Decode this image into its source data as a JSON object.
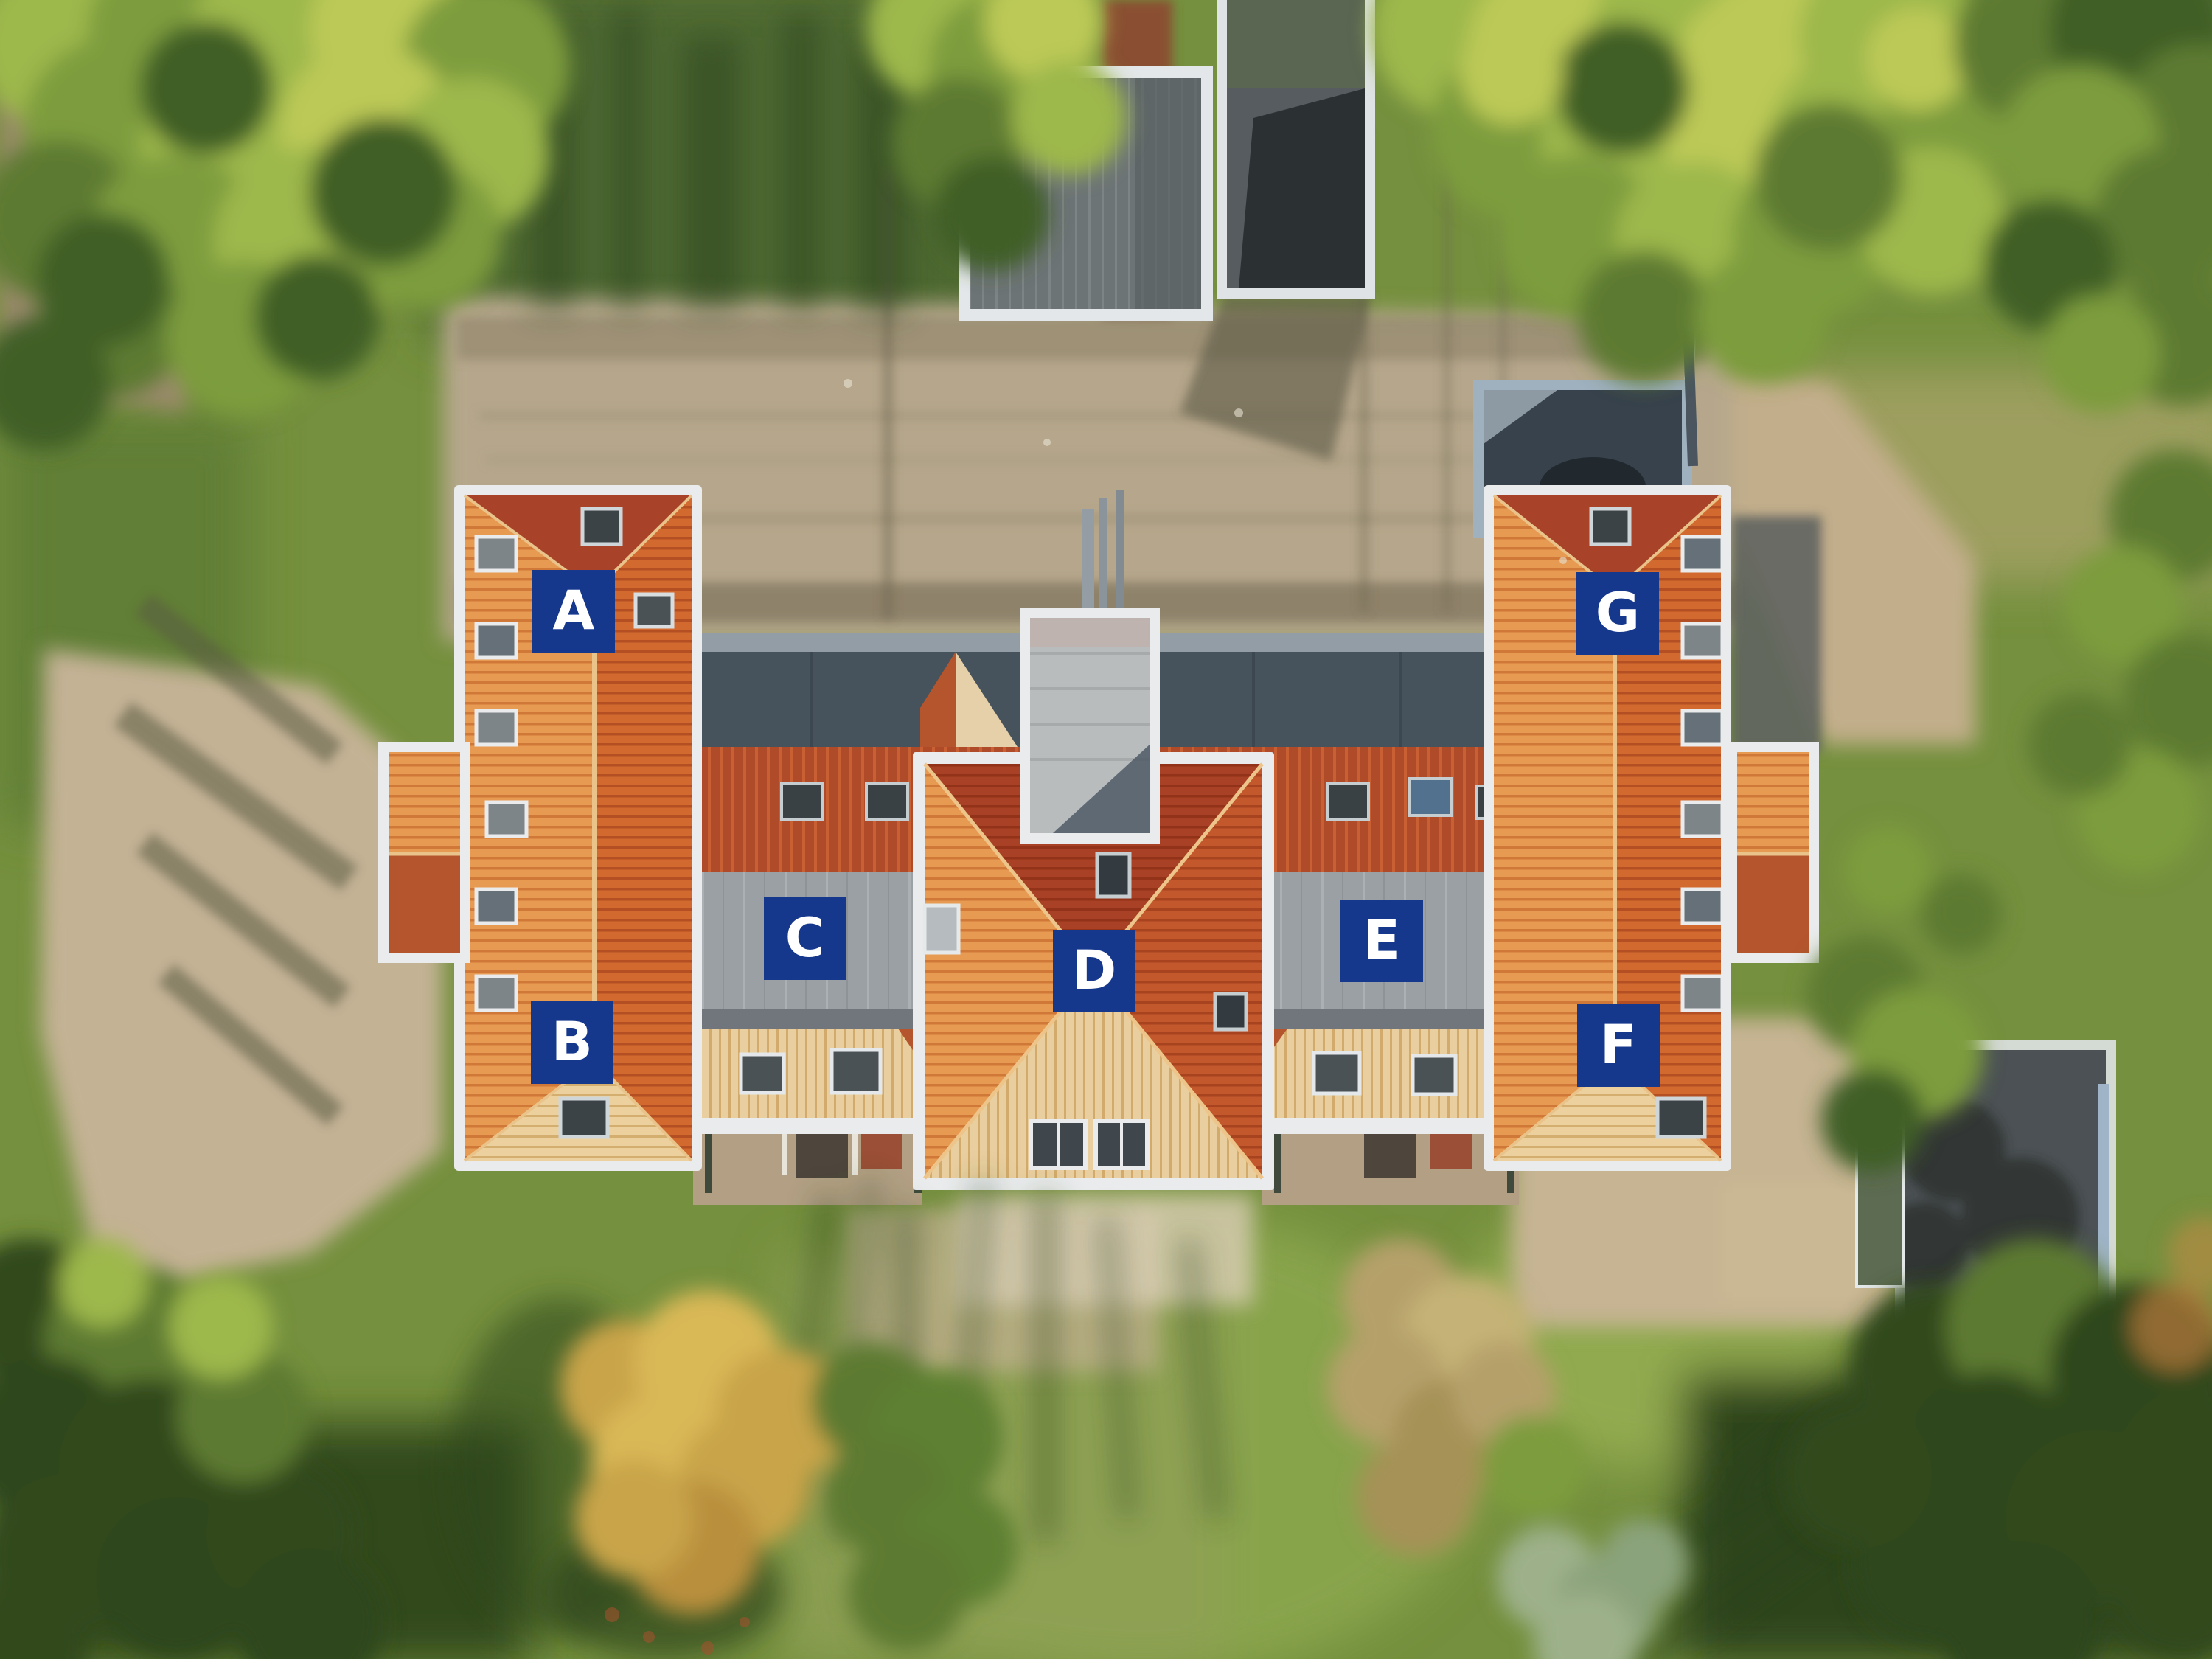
{
  "unit_labels": [
    {
      "letter": "A"
    },
    {
      "letter": "B"
    },
    {
      "letter": "C"
    },
    {
      "letter": "D"
    },
    {
      "letter": "E"
    },
    {
      "letter": "F"
    },
    {
      "letter": "G"
    }
  ],
  "colors": {
    "label_background": "#15378c",
    "label_text": "#ffffff",
    "roof_tile_light": "#e79a52",
    "roof_tile_mid": "#d2692f",
    "roof_tile_dark_red": "#a8432a",
    "roof_tile_cream": "#e9cf9f",
    "flat_roof_gray": "#9aa0a4",
    "corridor_roof_dark": "#46525c",
    "sand": "#c4b295",
    "grass": "#75903e"
  }
}
